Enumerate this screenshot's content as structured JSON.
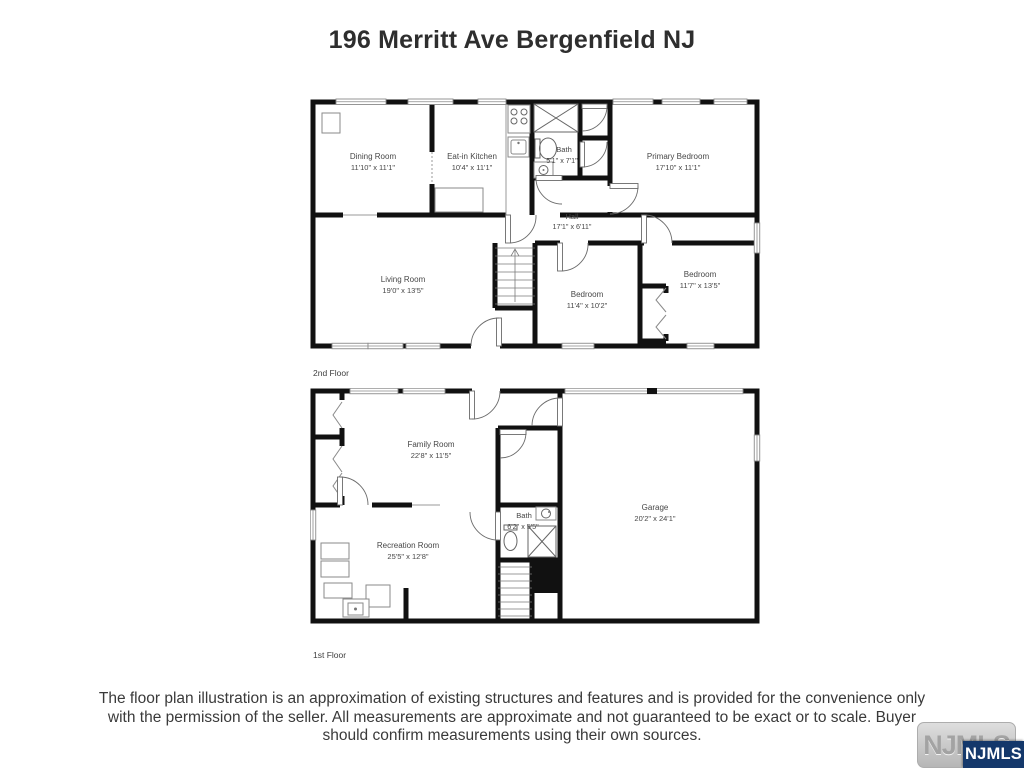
{
  "page": {
    "title": "196 Merritt Ave Bergenfield NJ"
  },
  "colors": {
    "wall": "#111111",
    "label_text": "#474747",
    "logo_blue": "#14386b",
    "logo_gray_bg": "#c6c6c6"
  },
  "floors": {
    "second": {
      "label": "2nd Floor",
      "rooms": {
        "dining": {
          "name": "Dining Room",
          "dims": "11'10\" x 11'1\""
        },
        "kitchen": {
          "name": "Eat-in Kitchen",
          "dims": "10'4\" x 11'1\""
        },
        "bath": {
          "name": "Bath",
          "dims": "5'1\" x 7'1\""
        },
        "primary": {
          "name": "Primary Bedroom",
          "dims": "17'10\" x 11'1\""
        },
        "hall": {
          "name": "Hall",
          "dims": "17'1\" x 6'11\""
        },
        "living": {
          "name": "Living Room",
          "dims": "19'0\" x 13'5\""
        },
        "bedroom2": {
          "name": "Bedroom",
          "dims": "11'4\" x 10'2\""
        },
        "bedroom3": {
          "name": "Bedroom",
          "dims": "11'7\" x 13'5\""
        }
      }
    },
    "first": {
      "label": "1st Floor",
      "rooms": {
        "family": {
          "name": "Family Room",
          "dims": "22'8\" x 11'5\""
        },
        "garage": {
          "name": "Garage",
          "dims": "20'2\" x 24'1\""
        },
        "recreation": {
          "name": "Recreation Room",
          "dims": "25'5\" x 12'8\""
        },
        "bath": {
          "name": "Bath",
          "dims": "6'2\" x 5'5\""
        }
      }
    }
  },
  "disclaimer": "The floor plan illustration is an approximation of existing structures and features and is provided for the convenience only with the permission of the seller. All measurements are approximate and not guaranteed to be exact or to scale. Buyer should confirm measurements using their own sources.",
  "logo": {
    "name": "NJMLS"
  }
}
